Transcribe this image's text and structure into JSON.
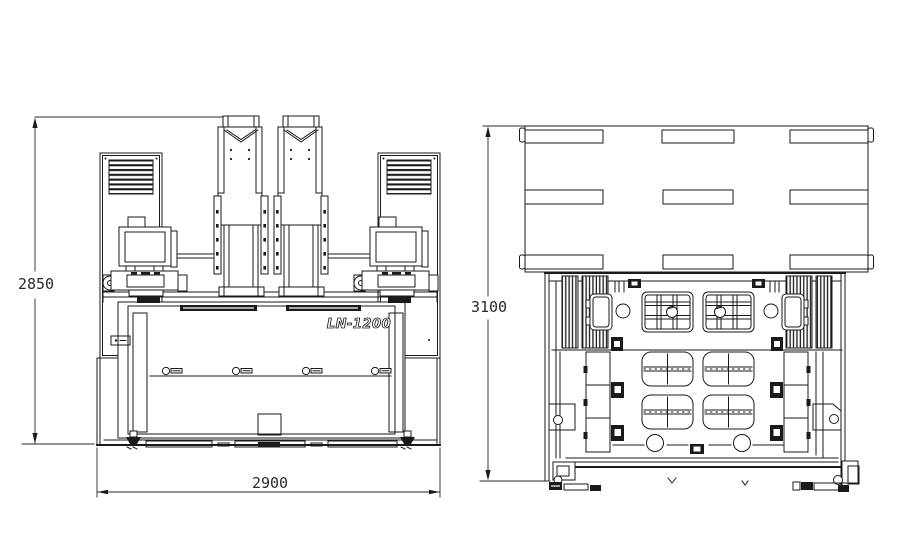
{
  "page": {
    "background_color": "#ffffff",
    "line_color": "#1a1a1a"
  },
  "drawing": {
    "model_label": "LN-1200",
    "front_view": {
      "height_dim": "2850",
      "width_dim": "2900"
    },
    "side_view": {
      "height_dim": "3100"
    }
  }
}
